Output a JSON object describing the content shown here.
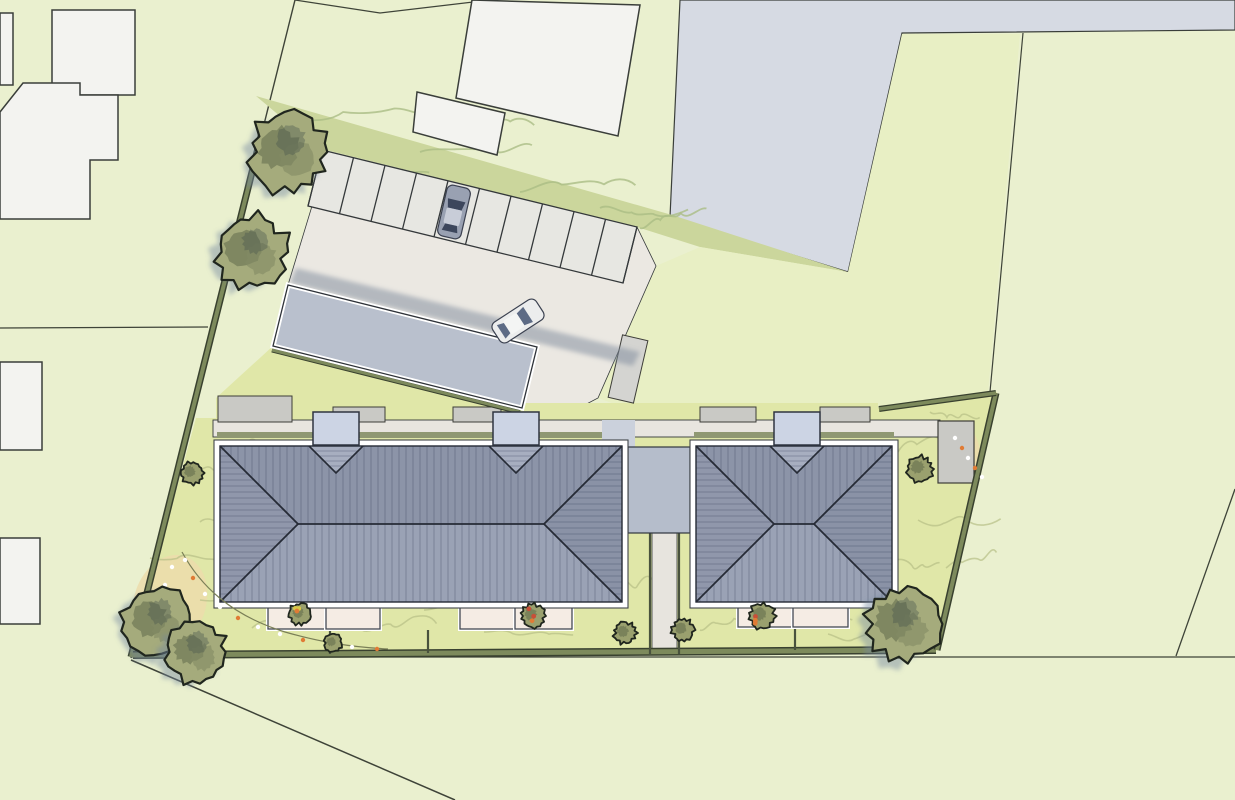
{
  "meta": {
    "title": "Residential development site plan",
    "type": "architectural-site-plan",
    "view": "top-down"
  },
  "inventory": {
    "parking_stalls": 10,
    "parked_cars": 1,
    "moving_cars": 1,
    "apartment_buildings": 2,
    "entrance_canopies_left_building": 2,
    "entrance_canopies_right_building": 1,
    "garage_outbuilding": 1,
    "connector_block": 1,
    "garden_shed": 1,
    "large_trees": 5,
    "shrubs": 8,
    "terraces": 6,
    "neighbor_buildings": 6
  },
  "palette": {
    "bg": "#eaf0cf",
    "band": "#cbd69c",
    "bandSquiggle": "#aabd85",
    "field": "#e8efc4",
    "garden": "#e0e7a8",
    "contour": "#b6bf86",
    "hedge": "#7d8a5c",
    "hedgeDark": "#39412f",
    "hedgeStrip": "#8f9873",
    "drive": "#ebe8e2",
    "walkway": "#e8e5df",
    "stall": "#e7e7e2",
    "stallLine": "#34383a",
    "pathStrip": "#e7e4de",
    "roofTop": "#8c94a8",
    "roofBottom": "#9aa2b5",
    "roofEndL": "#9097ab",
    "roofEndR": "#8a92a6",
    "roofNotch": "#a7aec0",
    "roofHatch": "rgba(50,60,84,0.30)",
    "roofLine": "#262b36",
    "gutter": "#ffffff",
    "gutterStroke": "#3f4449",
    "canopy": "#ccd4e4",
    "connector": "#b5bdcb",
    "garage": "#b9c0cd",
    "shadow": "rgba(125,138,155,0.5)",
    "pad": "#c9c9c5",
    "padRot": "#d4d4d1",
    "padStroke": "#3d3d38",
    "shed": "#c9c9c5",
    "terrace": "#f5ece4",
    "terraceStroke": "#454a54",
    "neighbor": "#f3f3f0",
    "neighborStroke": "#3a3e3a",
    "grayBuilding": "#d6dae3",
    "line": "#3e4338",
    "treeFill": "#a5ab7c",
    "treeBlotch1": "rgba(90,100,70,0.5)",
    "treeBlotch2": "rgba(70,85,75,0.38)",
    "treeBlotch3": "rgba(130,138,100,0.6)",
    "treeStroke": "#20261e",
    "treeShadow": "rgba(115,135,160,0.45)",
    "shrubFill": "#9aa06e",
    "sand": "#ecdcab",
    "dotWhite": "#ffffff",
    "dotOrange": "#e07b35",
    "dotRed": "#c94f38",
    "dotYellow": "#d8c948",
    "carDarkBody": "#99a1b2",
    "carDarkRoof": "#c8cdd8",
    "carDarkGlass": "#3c465c",
    "carWhiteBody": "#eceded",
    "carWhiteRoof": "#f4f5f4",
    "carWhiteGlass": "#5d6b85",
    "carStroke": "#3b4150"
  }
}
